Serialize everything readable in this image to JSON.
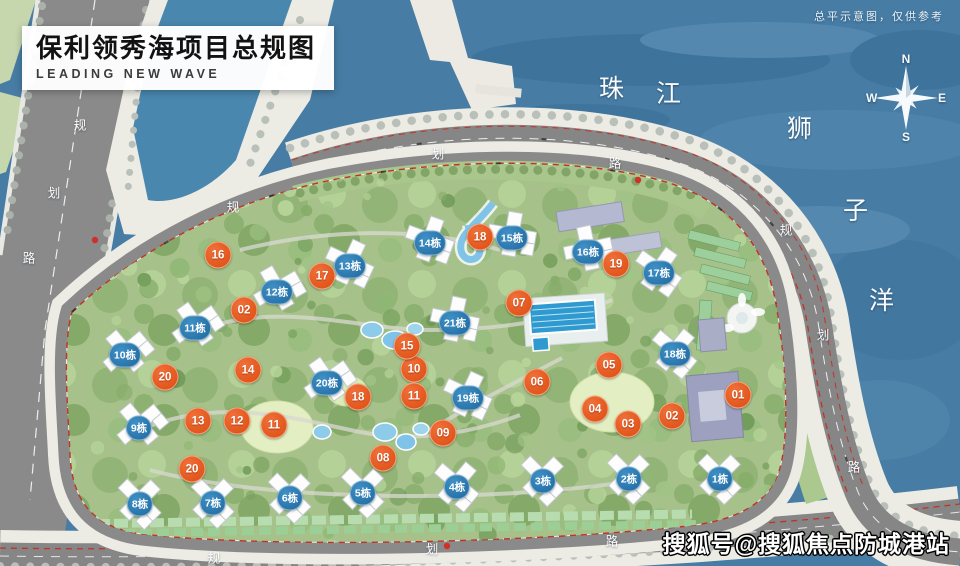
{
  "title": {
    "main": "保利领秀海项目总规图",
    "subtitle": "LEADING NEW WAVE"
  },
  "disclaimer": "总平示意图，仅供参考",
  "watermark": "搜狐号@搜狐焦点防城港站",
  "compass": {
    "n": "N",
    "e": "E",
    "s": "S",
    "w": "W"
  },
  "map_labels": [
    {
      "text": "珠",
      "x": 612,
      "y": 87,
      "kind": "water"
    },
    {
      "text": "江",
      "x": 669,
      "y": 92,
      "kind": "water"
    },
    {
      "text": "狮",
      "x": 800,
      "y": 127,
      "kind": "water"
    },
    {
      "text": "子",
      "x": 856,
      "y": 209,
      "kind": "water"
    },
    {
      "text": "洋",
      "x": 882,
      "y": 299,
      "kind": "water"
    },
    {
      "text": "规",
      "x": 80,
      "y": 124,
      "kind": "road"
    },
    {
      "text": "划",
      "x": 54,
      "y": 192,
      "kind": "road"
    },
    {
      "text": "路",
      "x": 29,
      "y": 257,
      "kind": "road"
    },
    {
      "text": "规",
      "x": 233,
      "y": 206,
      "kind": "road"
    },
    {
      "text": "划",
      "x": 438,
      "y": 153,
      "kind": "road"
    },
    {
      "text": "路",
      "x": 615,
      "y": 162,
      "kind": "road"
    },
    {
      "text": "规",
      "x": 786,
      "y": 229,
      "kind": "road"
    },
    {
      "text": "划",
      "x": 823,
      "y": 334,
      "kind": "road"
    },
    {
      "text": "路",
      "x": 854,
      "y": 466,
      "kind": "road"
    },
    {
      "text": "规",
      "x": 214,
      "y": 557,
      "kind": "road"
    },
    {
      "text": "划",
      "x": 432,
      "y": 548,
      "kind": "road"
    },
    {
      "text": "路",
      "x": 612,
      "y": 540,
      "kind": "road"
    },
    {
      "text": "路",
      "x": 694,
      "y": 537,
      "kind": "road"
    }
  ],
  "node_markers": [
    {
      "label": "01",
      "x": 738,
      "y": 395
    },
    {
      "label": "02",
      "x": 672,
      "y": 416
    },
    {
      "label": "02",
      "x": 244,
      "y": 310
    },
    {
      "label": "03",
      "x": 628,
      "y": 424
    },
    {
      "label": "04",
      "x": 595,
      "y": 409
    },
    {
      "label": "05",
      "x": 609,
      "y": 365
    },
    {
      "label": "06",
      "x": 537,
      "y": 382
    },
    {
      "label": "07",
      "x": 519,
      "y": 303
    },
    {
      "label": "08",
      "x": 383,
      "y": 458
    },
    {
      "label": "09",
      "x": 443,
      "y": 433
    },
    {
      "label": "10",
      "x": 414,
      "y": 369
    },
    {
      "label": "11",
      "x": 414,
      "y": 396
    },
    {
      "label": "11",
      "x": 274,
      "y": 425
    },
    {
      "label": "12",
      "x": 237,
      "y": 421
    },
    {
      "label": "13",
      "x": 198,
      "y": 421
    },
    {
      "label": "14",
      "x": 248,
      "y": 370
    },
    {
      "label": "15",
      "x": 407,
      "y": 346
    },
    {
      "label": "16",
      "x": 218,
      "y": 255
    },
    {
      "label": "17",
      "x": 322,
      "y": 276
    },
    {
      "label": "18",
      "x": 480,
      "y": 237
    },
    {
      "label": "18",
      "x": 358,
      "y": 397
    },
    {
      "label": "19",
      "x": 616,
      "y": 264
    },
    {
      "label": "20",
      "x": 165,
      "y": 377
    },
    {
      "label": "20",
      "x": 192,
      "y": 469
    }
  ],
  "unit_markers": [
    {
      "label": "1栋",
      "x": 720,
      "y": 479
    },
    {
      "label": "2栋",
      "x": 629,
      "y": 479
    },
    {
      "label": "3栋",
      "x": 543,
      "y": 481
    },
    {
      "label": "4栋",
      "x": 457,
      "y": 487
    },
    {
      "label": "5栋",
      "x": 363,
      "y": 493
    },
    {
      "label": "6栋",
      "x": 290,
      "y": 498
    },
    {
      "label": "7栋",
      "x": 213,
      "y": 503
    },
    {
      "label": "8栋",
      "x": 140,
      "y": 504
    },
    {
      "label": "9栋",
      "x": 139,
      "y": 428
    },
    {
      "label": "10栋",
      "x": 125,
      "y": 355
    },
    {
      "label": "11栋",
      "x": 195,
      "y": 328
    },
    {
      "label": "12栋",
      "x": 277,
      "y": 292
    },
    {
      "label": "13栋",
      "x": 350,
      "y": 266
    },
    {
      "label": "14栋",
      "x": 430,
      "y": 243
    },
    {
      "label": "15栋",
      "x": 512,
      "y": 238
    },
    {
      "label": "16栋",
      "x": 588,
      "y": 252
    },
    {
      "label": "17栋",
      "x": 659,
      "y": 273
    },
    {
      "label": "18栋",
      "x": 675,
      "y": 354
    },
    {
      "label": "19栋",
      "x": 468,
      "y": 398
    },
    {
      "label": "20栋",
      "x": 327,
      "y": 383
    },
    {
      "label": "21栋",
      "x": 455,
      "y": 323
    }
  ],
  "colors": {
    "water": "#477ca4",
    "site_green": "#a6c189",
    "road_grey": "#878787",
    "node_marker": "#dd4c10",
    "unit_marker": "#2d7cb5",
    "boundary_red": "#c23327"
  }
}
